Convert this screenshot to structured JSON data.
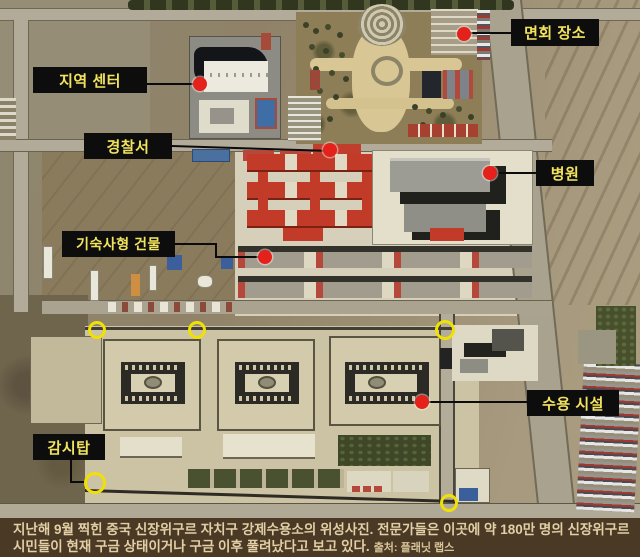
{
  "annotations": {
    "labels": [
      {
        "id": "regional-center",
        "text": "지역 센터"
      },
      {
        "id": "visiting-area",
        "text": "면회 장소"
      },
      {
        "id": "police-station",
        "text": "경찰서"
      },
      {
        "id": "hospital",
        "text": "병원"
      },
      {
        "id": "dormitory-buildings",
        "text": "기숙사형 건물"
      },
      {
        "id": "detention-facility",
        "text": "수용 시설"
      },
      {
        "id": "watchtower",
        "text": "감시탑"
      }
    ],
    "marker_colors": {
      "red_dot": "#e4211a",
      "yellow_ring": "#f0e105",
      "label_bg": "#0d0d0d",
      "label_text": "#f2e35f"
    },
    "red_dot_count": 6,
    "yellow_ring_count": 5
  },
  "caption": {
    "line1": "지난해 9월 찍힌 중국 신장위구르 자치구 강제수용소의 위성사진. 전문가들은 이곳에 약 180만 명의 신장위구르",
    "line2": "시민들이 현재 구금 상태이거나 구금 이후 풀려났다고 보고 있다.",
    "source": "출처: 플래닛 랩스",
    "bg": "#4a3925",
    "text_color": "#e2cfa6"
  }
}
